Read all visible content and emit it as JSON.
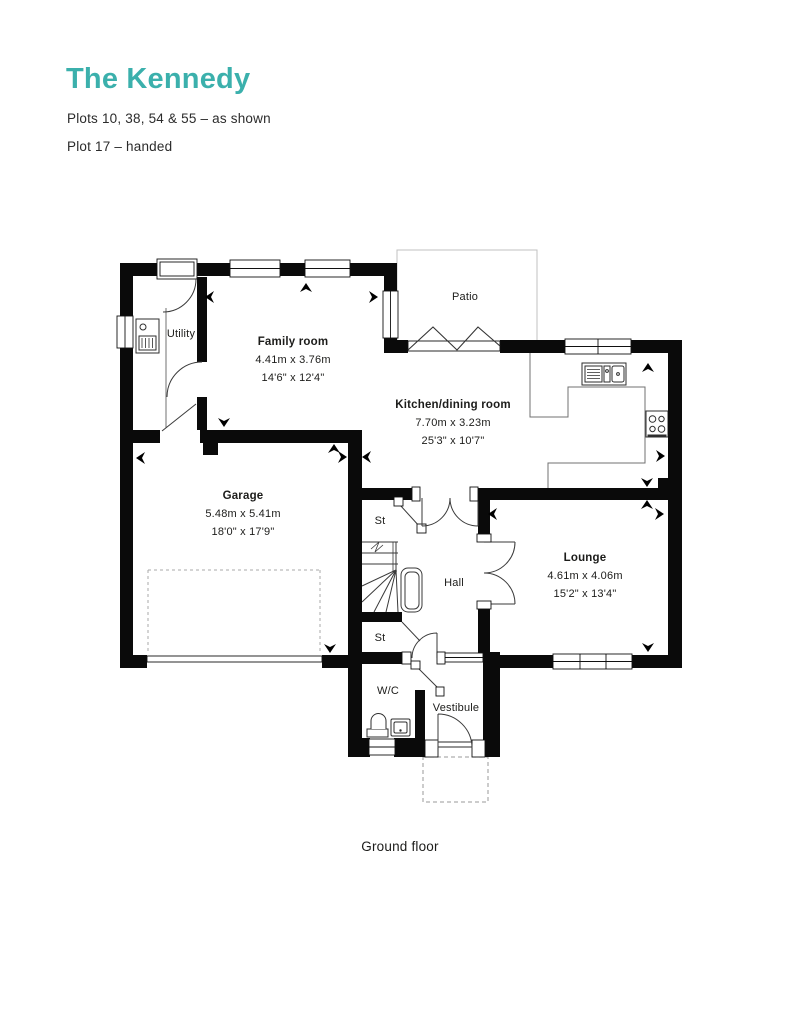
{
  "header": {
    "title": "The Kennedy",
    "subtitle1": "Plots 10, 38, 54 & 55 – as shown",
    "subtitle2": "Plot 17 – handed"
  },
  "caption": "Ground floor",
  "colors": {
    "accent": "#3bb0ac",
    "wall": "#0a0a0a",
    "text": "#1c1c1a"
  },
  "rooms": {
    "utility": {
      "label": "Utility"
    },
    "family": {
      "label": "Family room",
      "dims_metric": "4.41m x 3.76m",
      "dims_imperial": "14'6\" x 12'4\""
    },
    "kitchen": {
      "label": "Kitchen/dining room",
      "dims_metric": "7.70m x 3.23m",
      "dims_imperial": "25'3\" x 10'7\""
    },
    "garage": {
      "label": "Garage",
      "dims_metric": "5.48m x 5.41m",
      "dims_imperial": "18'0\" x 17'9\""
    },
    "lounge": {
      "label": "Lounge",
      "dims_metric": "4.61m x 4.06m",
      "dims_imperial": "15'2\" x 13'4\""
    },
    "hall": {
      "label": "Hall"
    },
    "st_upper": {
      "label": "St"
    },
    "st_lower": {
      "label": "St"
    },
    "wc": {
      "label": "W/C"
    },
    "vestibule": {
      "label": "Vestibule"
    },
    "patio": {
      "label": "Patio"
    }
  }
}
